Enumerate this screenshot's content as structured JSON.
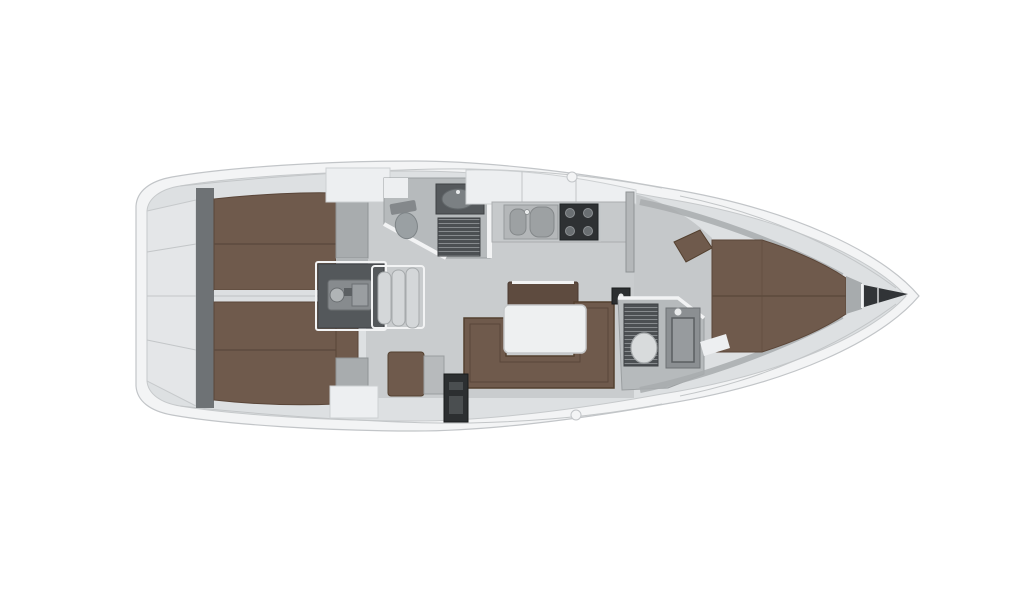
{
  "diagram": {
    "kind": "sailing-yacht-interior-floor-plan",
    "view": "top-down",
    "orientation": "bow-right-stern-left"
  },
  "regions": {
    "stern_lazarette": "stern lazarette",
    "aft_cabin_port": "aft double cabin port",
    "aft_cabin_starboard": "aft double cabin starboard",
    "engine_compartment": "engine compartment",
    "companionway_steps": "companionway steps",
    "aft_head": "aft head wc shower",
    "galley": "galley with sink and stove",
    "salon": "salon u-settee with table",
    "nav_station": "nav station",
    "forward_head": "forward head wc shower",
    "forward_cabin": "forward v-berth cabin",
    "anchor_locker": "bow anchor locker"
  },
  "colors": {
    "background": "#ffffff",
    "hull_shell": "#f3f4f5",
    "hull_outline": "#c2c5c8",
    "deck": "#dde0e2",
    "deck_seam": "#c3c6c8",
    "transom_panel": "#e4e6e8",
    "bulkhead_dark": "#6e7275",
    "floor": "#c9ccce",
    "floor_fwd": "#c5c8ca",
    "room_floor": "#b6babc",
    "berth_brown": "#6f5a4c",
    "berth_seam": "#5a4639",
    "berth_edge": "#53402f",
    "bench_brown": "#5e4b3f",
    "foot_gray": "#a8acae",
    "locker_white": "#edeff1",
    "wall_white": "#f2f3f4",
    "divider": "#dcdfe1",
    "engine_room": "#54585b",
    "engine_block": "#878b8e",
    "step_tread": "#d4d7d9",
    "step_edge": "#a6aaac",
    "counter": "#c6c9cb",
    "sink_panel": "#b4b7b9",
    "basin": "#9da1a3",
    "stove_dark": "#2e3133",
    "burner": "#6a6f72",
    "grate_dark": "#4c5053",
    "grate_line": "#878b8e",
    "fixture_gray": "#d8dbdc",
    "fixture_edge": "#a5a9ab",
    "shower_gray": "#8b8f92",
    "locker_dark": "#2c2f31",
    "table_white": "#eef0f1",
    "table_edge": "#c5c8ca",
    "toilet_gray": "#9aa0a3",
    "bow_band": "#a7abad",
    "bow_dark": "#313437"
  }
}
